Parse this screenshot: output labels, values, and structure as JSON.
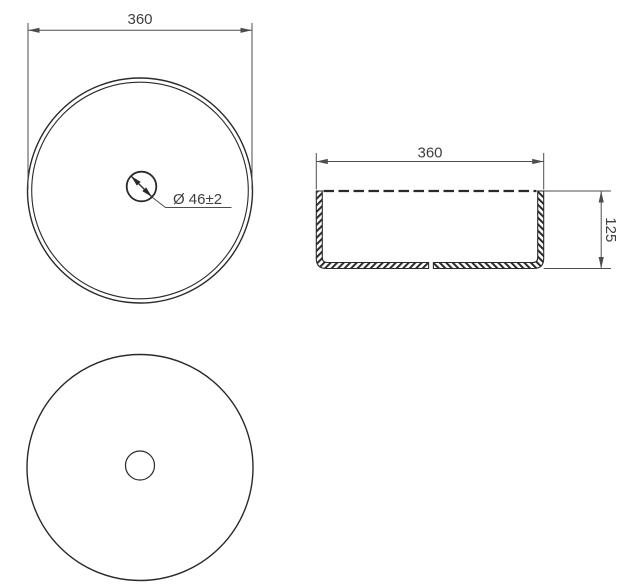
{
  "colors": {
    "background": "#ffffff",
    "line_color": "#2a2a2a",
    "dim_color": "#4d4d4d",
    "text_color": "#3d4043"
  },
  "top_view": {
    "diameter_dimension": "360",
    "drain_dimension": "Ø 46±2"
  },
  "side_view": {
    "width_dimension": "360",
    "height_dimension": "125"
  }
}
